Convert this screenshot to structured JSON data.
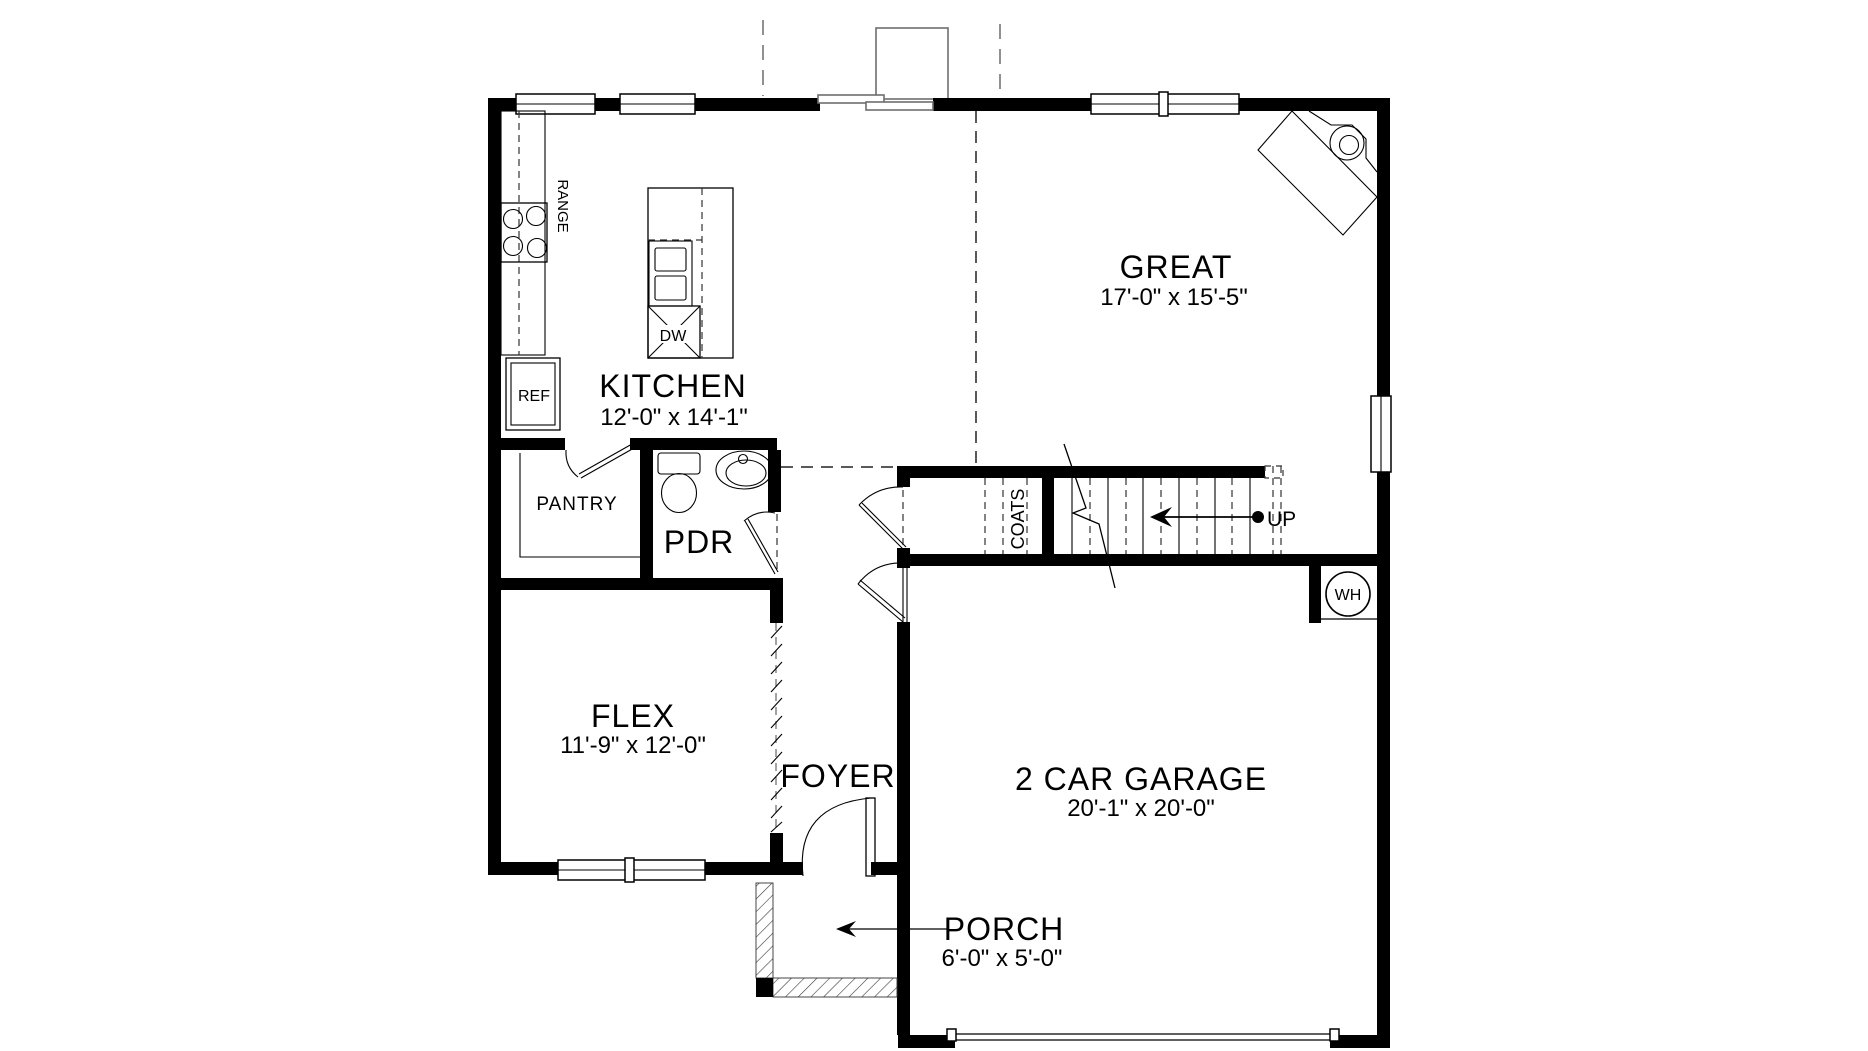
{
  "page": {
    "background": "#ffffff",
    "wall_color": "#000000",
    "line_color": "#222222",
    "gray_accent": "#6e6e6e"
  },
  "rooms": {
    "kitchen": {
      "label": "KITCHEN",
      "dims": "12'-0\" x 14'-1\""
    },
    "great": {
      "label": "GREAT",
      "dims": "17'-0\" x 15'-5\""
    },
    "flex": {
      "label": "FLEX",
      "dims": "11'-9\" x 12'-0\""
    },
    "garage": {
      "label": "2 CAR GARAGE",
      "dims": "20'-1\" x 20'-0\""
    },
    "porch": {
      "label": "PORCH",
      "dims": "6'-0\" x 5'-0\""
    },
    "foyer": {
      "label": "FOYER"
    },
    "powder_room": {
      "label": "PDR"
    },
    "pantry": {
      "label": "PANTRY"
    },
    "coat_closet": {
      "label": "COATS"
    }
  },
  "fixtures": {
    "range": {
      "label": "RANGE"
    },
    "refrigerator": {
      "label": "REF"
    },
    "dishwasher": {
      "label": "DW"
    },
    "water_heater": {
      "label": "WH"
    },
    "stairs": {
      "label": "UP"
    }
  }
}
